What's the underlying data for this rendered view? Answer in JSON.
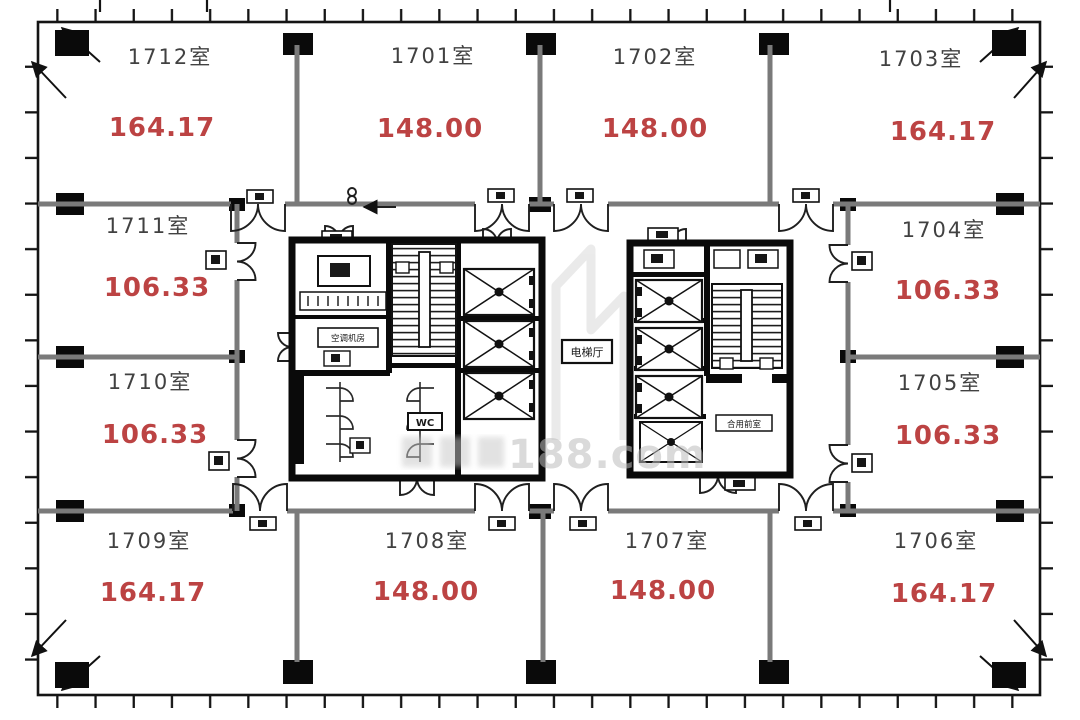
{
  "plan": {
    "rooms": [
      {
        "name": "1712室",
        "area": "164.17"
      },
      {
        "name": "1701室",
        "area": "148.00"
      },
      {
        "name": "1702室",
        "area": "148.00"
      },
      {
        "name": "1703室",
        "area": "164.17"
      },
      {
        "name": "1711室",
        "area": "106.33"
      },
      {
        "name": "1710室",
        "area": "106.33"
      },
      {
        "name": "1704室",
        "area": "106.33"
      },
      {
        "name": "1705室",
        "area": "106.33"
      },
      {
        "name": "1709室",
        "area": "164.17"
      },
      {
        "name": "1708室",
        "area": "148.00"
      },
      {
        "name": "1707室",
        "area": "148.00"
      },
      {
        "name": "1706室",
        "area": "164.17"
      }
    ],
    "core": {
      "elevator_hall": "电梯厅",
      "ac_room": "空调机房",
      "shared_vestibule": "合用前室",
      "wc": "WC"
    },
    "watermark": {
      "text": "188.com"
    },
    "colors": {
      "area_red": "#bc4343",
      "room_gray": "#414141",
      "watermark_gray": "#bdbdbd"
    }
  }
}
